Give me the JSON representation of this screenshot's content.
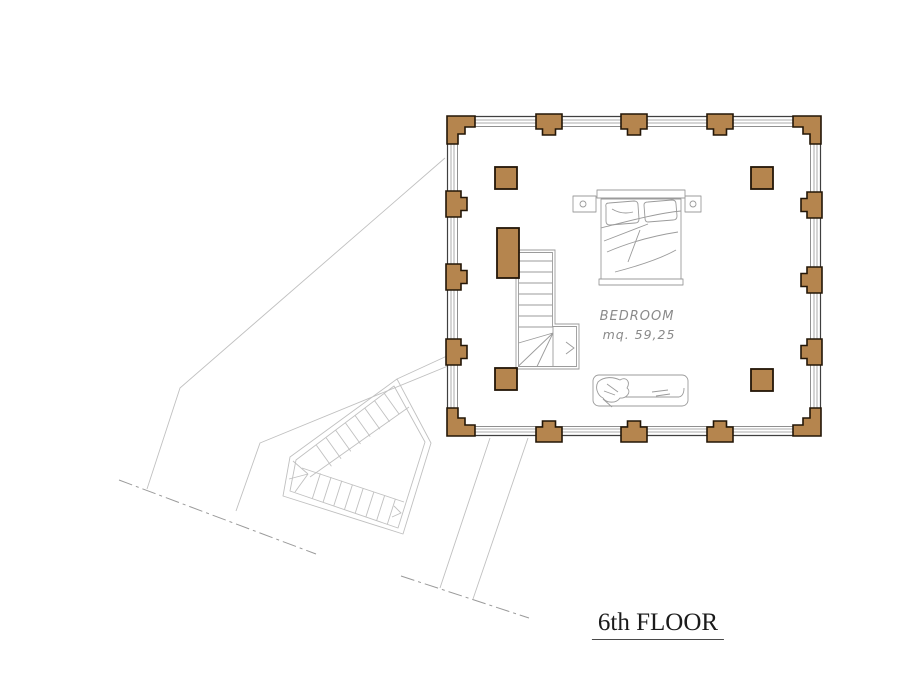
{
  "floor_plan": {
    "title": "6th FLOOR",
    "room": {
      "label": "BEDROOM",
      "area": "mq. 59,25"
    },
    "colors": {
      "pillar": "#b5854e",
      "pillar-stroke": "#231607",
      "wall-dark": "#3f3f3f",
      "wall-glass": "#ababab",
      "wall-inner": "#8f8f8f",
      "sketch": "#9b9b9b",
      "faint": "#c0c0c0",
      "dash": "#9a9a9a",
      "label": "#8a8a8a",
      "title": "#1b1b1b"
    },
    "elements": [
      "perimeter-colonnade",
      "glass-curtain-walls",
      "interior-columns",
      "staircase-up",
      "stair-direction-arrow",
      "double-bed",
      "single-bed",
      "lower-floor-outline",
      "winder-staircase-below",
      "boundary-dash-lines"
    ]
  }
}
